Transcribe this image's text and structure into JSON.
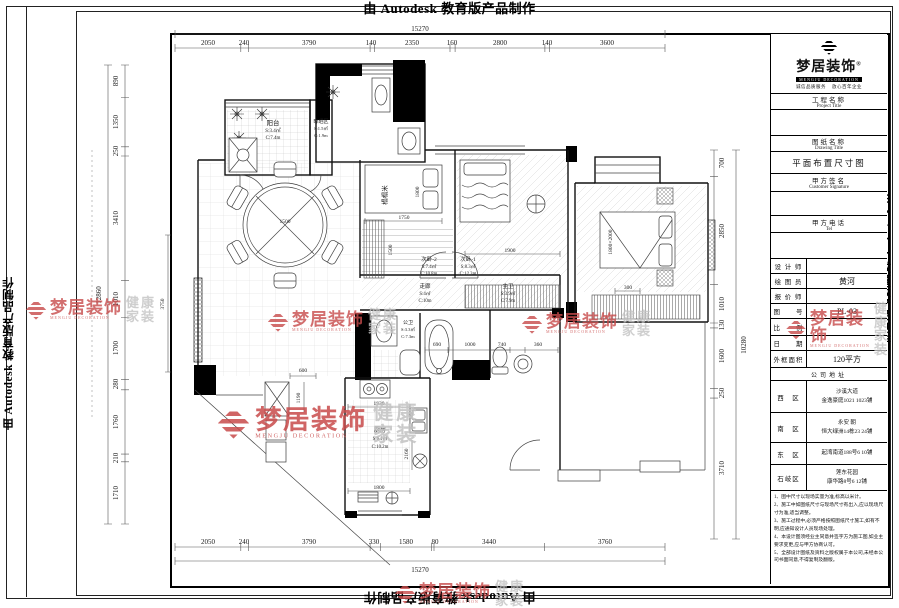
{
  "page": {
    "stamp": "由 Autodesk 教育版产品制作"
  },
  "brand": {
    "name": "梦居装饰",
    "reg": "®",
    "sub": "MENGJU DECORATION",
    "tag1": "诚信品质服务",
    "tag2": "放心百年企业",
    "wm_gray1": "健康",
    "wm_gray2": "家装"
  },
  "title_block": {
    "project_label": "工程名称",
    "project_sublabel": "Project Title",
    "project_value": "",
    "drawing_label": "图纸名称",
    "drawing_sublabel": "Drawing Title",
    "drawing_value": "平面布置尺寸图",
    "signature_label": "甲方签名",
    "signature_sublabel": "Customer Signature",
    "signature_value": "",
    "tel_label": "甲方电话",
    "tel_sublabel": "Tel",
    "tel_value": "",
    "rows": [
      {
        "label": "设 计 师",
        "value": ""
      },
      {
        "label": "绘 图 员",
        "value": "黄河"
      },
      {
        "label": "报 价 师",
        "value": ""
      },
      {
        "label": "图　　号",
        "value": "PL-03"
      },
      {
        "label": "比　　例",
        "value": ""
      },
      {
        "label": "日　　期",
        "value": ""
      },
      {
        "label": "外框面积",
        "value": "120平方"
      }
    ],
    "address_header": "公司地址",
    "addresses": [
      {
        "label": "西　区",
        "line1": "沙溪大道",
        "line2": "金逸豪庭1021 1023铺"
      },
      {
        "label": "南　区",
        "line1": "永安 朝",
        "line2": "恒大绿洲14栋23 24铺"
      },
      {
        "label": "东　区",
        "line1": "起湾南道188号6 10铺",
        "line2": ""
      },
      {
        "label": "石岐区",
        "line1": "莲东花园",
        "line2": "康华路8号6 12铺"
      }
    ],
    "notes": [
      "1、图中尺寸以现场实量为准,标高以米计。",
      "2、施工中如图纸尺寸与现场尺寸有出入,应以现场尺寸为准,适当调整。",
      "3、施工过程中,必须严格按照图纸尺寸施工,如有不明,应通知设计人员现场处理。",
      "4、本设计图须经业主同意并签字方为施工图,如业主要求变更,应与甲方协商认可。",
      "5、全部设计图纸及资料之版权属于本公司,未经本公司书面同意,不得复制及翻版。"
    ]
  },
  "dims": {
    "top_total": "15270",
    "top": [
      "2050",
      "240",
      "3790",
      "140",
      "2350",
      "160",
      "2800",
      "140",
      "3600"
    ],
    "bottom": [
      "2050",
      "240",
      "3790",
      "330",
      "1580",
      "80",
      "3440",
      "3760"
    ],
    "bottom_total": "15270",
    "left": [
      "890",
      "1350",
      "250",
      "3410",
      "1010",
      "1700",
      "280",
      "1760",
      "210",
      "1710"
    ],
    "left_total": "12860",
    "right": [
      "700",
      "2850",
      "1010",
      "130",
      "1600",
      "250",
      "3710"
    ],
    "right_total": "10280"
  },
  "rooms": {
    "balcony": {
      "name": "阳台",
      "area": "S:3.4㎡",
      "perimeter": "C:7.4m"
    },
    "drying": {
      "name": "晾晒区",
      "area": "S:1.5㎡",
      "perimeter": "C:1.9m"
    },
    "tatami": {
      "name": "榻榻米"
    },
    "bedroom2": {
      "name": "次卧-2",
      "area": "S:7.4㎡",
      "perimeter": "C:10.8m"
    },
    "bedroom1": {
      "name": "次卧-1",
      "area": "S:8.3㎡",
      "perimeter": "C:12.3m"
    },
    "corridor": {
      "name": "走廊",
      "area": "S:4㎡",
      "perimeter": "C:10m"
    },
    "master_bath": {
      "name": "主卫",
      "area": "S:3.9㎡",
      "perimeter": "C:7.9m"
    },
    "guest_bath": {
      "name": "公卫",
      "area": "S:3.3㎡",
      "perimeter": "C:7.3m"
    },
    "kitchen": {
      "name": "厨房",
      "area": "S:6.1㎡",
      "perimeter": "C:10.2m"
    }
  },
  "inner_dims": {
    "tatami_w": "1800",
    "tatami_line": "1750",
    "tatami_d": "1500",
    "bed1": "1900",
    "master_bed": "1800×2000",
    "master_gap": "300",
    "table": "1500",
    "living_h": "3750",
    "hall": "600",
    "bath_a": "690",
    "bath_b": "1000",
    "bath_c": "740",
    "bath_d": "360",
    "kitchen_top": "1930",
    "kitchen_bottom": "1800",
    "kitchen_left": "1190",
    "kitchen_right": "2160"
  }
}
